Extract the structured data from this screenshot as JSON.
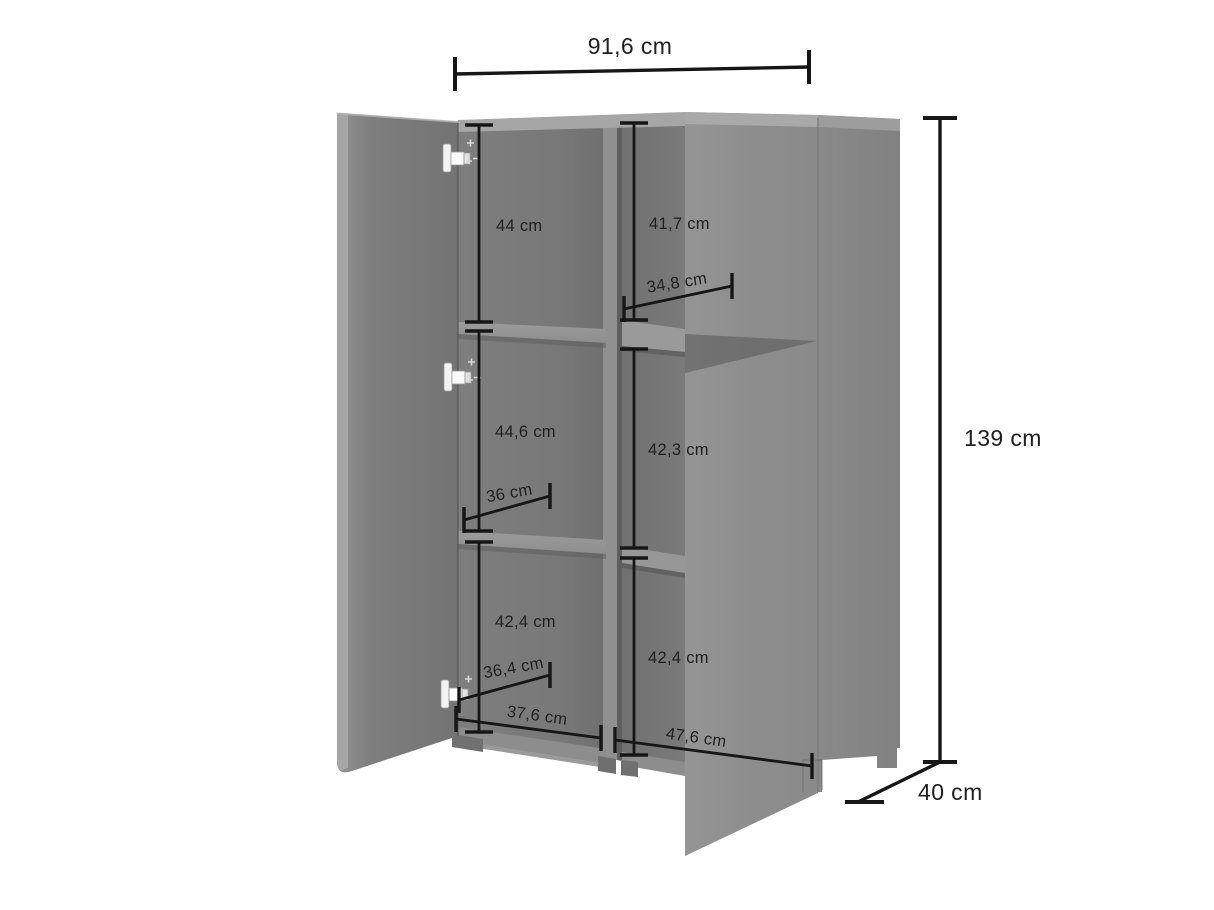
{
  "diagram": {
    "kind": "furniture-dimension-diagram",
    "unit": "cm",
    "labels": {
      "width": "91,6 cm",
      "height": "139 cm",
      "depth": "40 cm",
      "left_top": "44 cm",
      "left_middle": "44,6 cm",
      "left_bottom": "42,4 cm",
      "right_top": "41,7 cm",
      "right_middle": "42,3 cm",
      "right_bottom": "42,4 cm",
      "shelf_top": "34,8 cm",
      "shelf_middle": "36 cm",
      "shelf_bottom": "36,4 cm",
      "base_left": "37,6 cm",
      "base_right": "47,6 cm"
    },
    "colors": {
      "background": "#ffffff",
      "dimension_line": "#161616",
      "label_text": "#1f1f1f",
      "door_gray": "#8c8c8c",
      "interior_gray": "#747474",
      "partition_light": "#909090",
      "edge_light": "#a6a6a6",
      "shadow": "#5e5e5e",
      "hinge_white": "#f3f3f3"
    }
  }
}
